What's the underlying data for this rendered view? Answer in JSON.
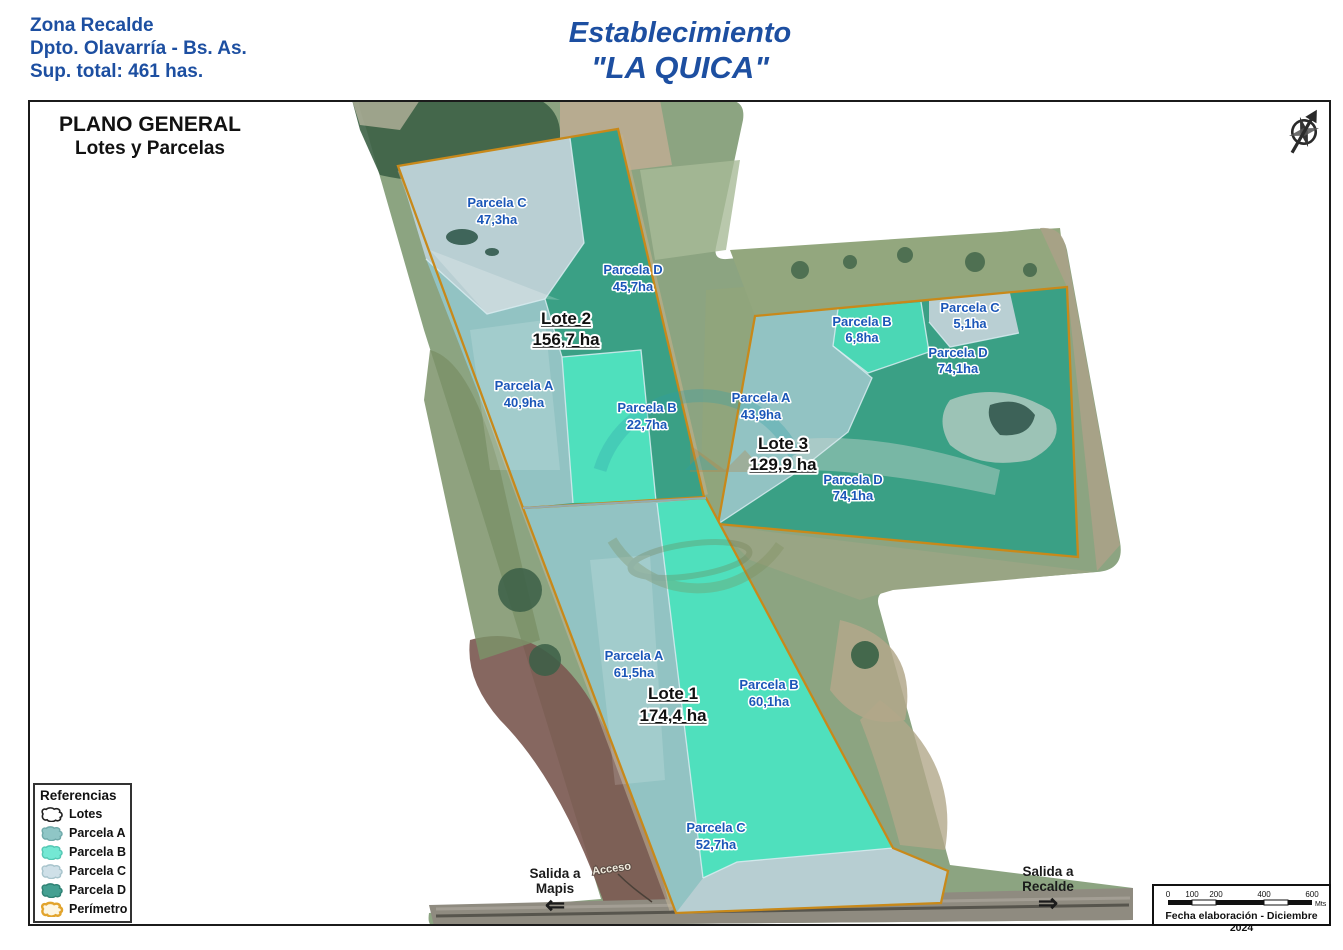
{
  "header": {
    "zone": "Zona Recalde",
    "department": "Dpto. Olavarría - Bs. As.",
    "total_area": "Sup. total: 461 has.",
    "establishment": "Establecimiento",
    "name": "\"LA QUICA\""
  },
  "map": {
    "title1": "PLANO GENERAL",
    "title2": "Lotes y Parcelas",
    "access_label": "Acceso",
    "lots": [
      {
        "id": "lote-2",
        "label": "Lote 2",
        "area": "156,7 ha",
        "parcels": [
          {
            "name": "Parcela C",
            "area": "47,3ha"
          },
          {
            "name": "Parcela D",
            "area": "45,7ha"
          },
          {
            "name": "Parcela A",
            "area": "40,9ha"
          },
          {
            "name": "Parcela B",
            "area": "22,7ha"
          }
        ]
      },
      {
        "id": "lote-3",
        "label": "Lote 3",
        "area": "129,9 ha",
        "parcels": [
          {
            "name": "Parcela B",
            "area": "6,8ha"
          },
          {
            "name": "Parcela C",
            "area": "5,1ha"
          },
          {
            "name": "Parcela D",
            "area": "74,1ha"
          },
          {
            "name": "Parcela A",
            "area": "43,9ha"
          },
          {
            "name": "Parcela D",
            "area": "74,1ha"
          }
        ]
      },
      {
        "id": "lote-1",
        "label": "Lote 1",
        "area": "174,4 ha",
        "parcels": [
          {
            "name": "Parcela A",
            "area": "61,5ha"
          },
          {
            "name": "Parcela B",
            "area": "60,1ha"
          },
          {
            "name": "Parcela C",
            "area": "52,7ha"
          }
        ]
      }
    ],
    "exits": [
      {
        "line1": "Salida a",
        "line2": "Mapis",
        "arrow": "⇐"
      },
      {
        "line1": "Salida a",
        "line2": "Recalde",
        "arrow": "⇒"
      }
    ]
  },
  "legend": {
    "title": "Referencias",
    "items": [
      {
        "label": "Lotes",
        "fill": "#ffffff",
        "stroke": "#222222"
      },
      {
        "label": "Parcela A",
        "fill": "#8fc6c6",
        "stroke": "#6fa9a9"
      },
      {
        "label": "Parcela B",
        "fill": "#74e8d4",
        "stroke": "#54c8b4"
      },
      {
        "label": "Parcela C",
        "fill": "#cfe0e8",
        "stroke": "#a8c4cc"
      },
      {
        "label": "Parcela D",
        "fill": "#44a092",
        "stroke": "#2f8274"
      },
      {
        "label": "Perímetro",
        "fill": "#fdf6e2",
        "stroke": "#e2a42d"
      }
    ]
  },
  "scalebar": {
    "ticks": [
      "0",
      "100",
      "200",
      "400",
      "600"
    ],
    "unit": "Mts",
    "note": "Fecha elaboración - Diciembre 2024"
  },
  "colors": {
    "header_blue": "#1d4fa1",
    "label_blue": "#1a56b8",
    "perimeter": "#c8891a",
    "parcel_a": "#92c3c3",
    "parcel_b": "#4fe0bd",
    "parcel_c": "#b9cfd3",
    "parcel_d": "#3aa085"
  }
}
